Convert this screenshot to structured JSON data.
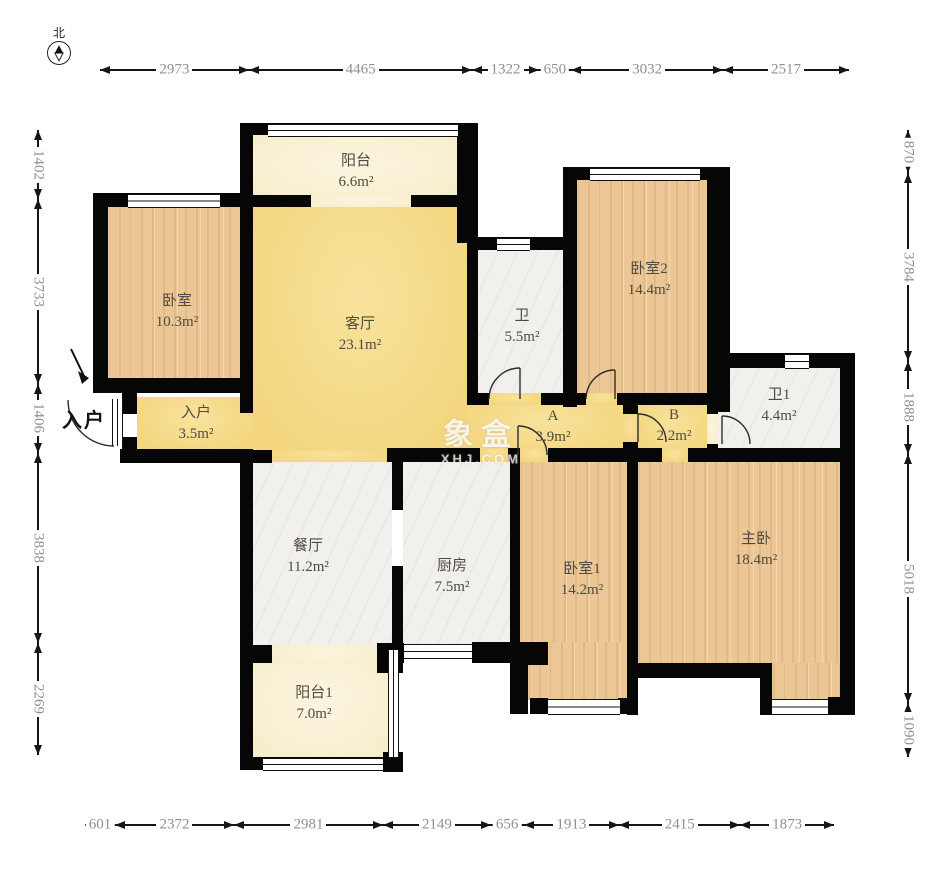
{
  "compass": {
    "north_label": "北"
  },
  "entry_marker": {
    "label": "入户"
  },
  "watermark": {
    "brand": "象盒",
    "domain": "XHJ.COM"
  },
  "rooms": [
    {
      "id": "balcony-top",
      "label": "阳台",
      "area": "6.6m²"
    },
    {
      "id": "bedroom-left",
      "label": "卧室",
      "area": "10.3m²"
    },
    {
      "id": "living-room",
      "label": "客厅",
      "area": "23.1m²"
    },
    {
      "id": "entry",
      "label": "入户",
      "area": "3.5m²"
    },
    {
      "id": "bathroom",
      "label": "卫",
      "area": "5.5m²"
    },
    {
      "id": "bedroom-2",
      "label": "卧室2",
      "area": "14.4m²"
    },
    {
      "id": "hall-a",
      "label": "A",
      "area": "3.9m²"
    },
    {
      "id": "hall-b",
      "label": "B",
      "area": "2.2m²"
    },
    {
      "id": "bathroom-1",
      "label": "卫1",
      "area": "4.4m²"
    },
    {
      "id": "dining-room",
      "label": "餐厅",
      "area": "11.2m²"
    },
    {
      "id": "kitchen",
      "label": "厨房",
      "area": "7.5m²"
    },
    {
      "id": "bedroom-1",
      "label": "卧室1",
      "area": "14.2m²"
    },
    {
      "id": "master-bedroom",
      "label": "主卧",
      "area": "18.4m²"
    },
    {
      "id": "balcony-1",
      "label": "阳台1",
      "area": "7.0m²"
    }
  ],
  "dimensions": {
    "top": [
      2973,
      4465,
      1322,
      650,
      3032,
      2517
    ],
    "left": [
      1402,
      3733,
      1406,
      3838,
      2269
    ],
    "right": [
      870,
      3784,
      1888,
      5018,
      1090
    ],
    "bottom": [
      601,
      2372,
      2981,
      2149,
      656,
      1913,
      2415,
      1873
    ]
  },
  "colors": {
    "wall": "#060606",
    "living_yellow": "#f5da87",
    "wood": "#ecc795",
    "balcony_pale": "#f8f1d6",
    "tile_white": "#f1f0ec",
    "dim_text": "#8f8f8f"
  }
}
